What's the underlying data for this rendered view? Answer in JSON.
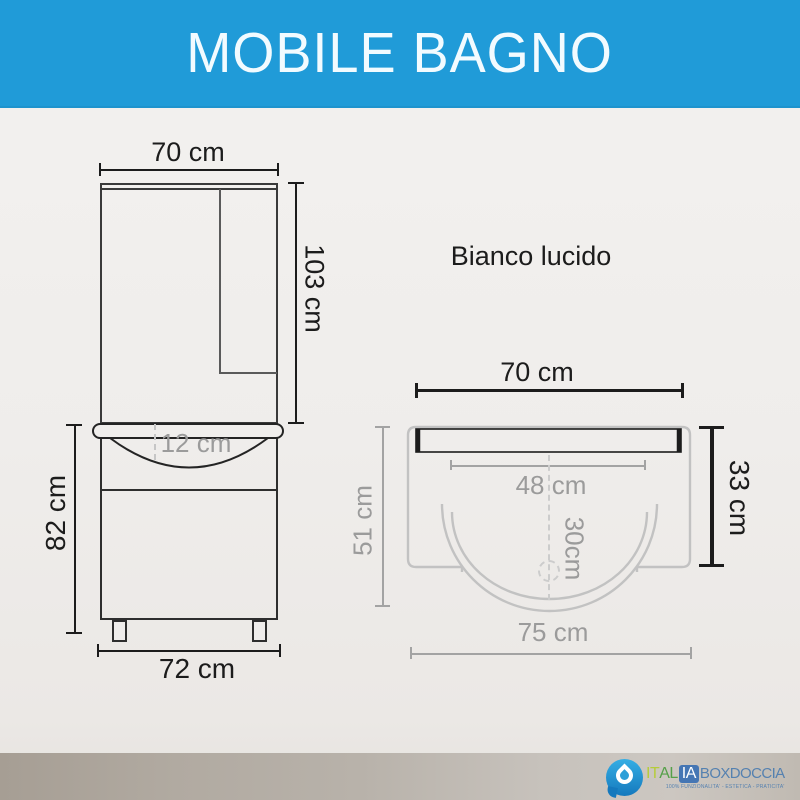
{
  "header": {
    "title": "MOBILE BAGNO"
  },
  "front_view": {
    "dim_mirror_width": "70 cm",
    "dim_mirror_height": "103 cm",
    "dim_basin_apron": "12 cm",
    "dim_cabinet_height": "82 cm",
    "dim_base_width": "72 cm"
  },
  "top_view": {
    "finish_label": "Bianco lucido",
    "dim_width": "70 cm",
    "dim_inner_width": "48 cm",
    "dim_depth_right": "33 cm",
    "dim_depth_left": "51 cm",
    "dim_basin_depth": "30cm",
    "dim_total_width": "75 cm"
  },
  "footer": {
    "logo": {
      "part_it": "IT",
      "part_al": "AL",
      "part_ia": "IA",
      "part_box": "BOXDOCCIA",
      "tagline": "100% FUNZIONALITA' - ESTETICA - PRATICITA'"
    }
  },
  "colors": {
    "header_bg": "#209bd8",
    "line_black": "#1c1c1c",
    "line_gray": "#9b9b9b",
    "outline_light": "#c2c2c2",
    "footer_band": "#b8b2aa",
    "logo_blue": "#4576b4",
    "logo_green": "#55a049"
  }
}
